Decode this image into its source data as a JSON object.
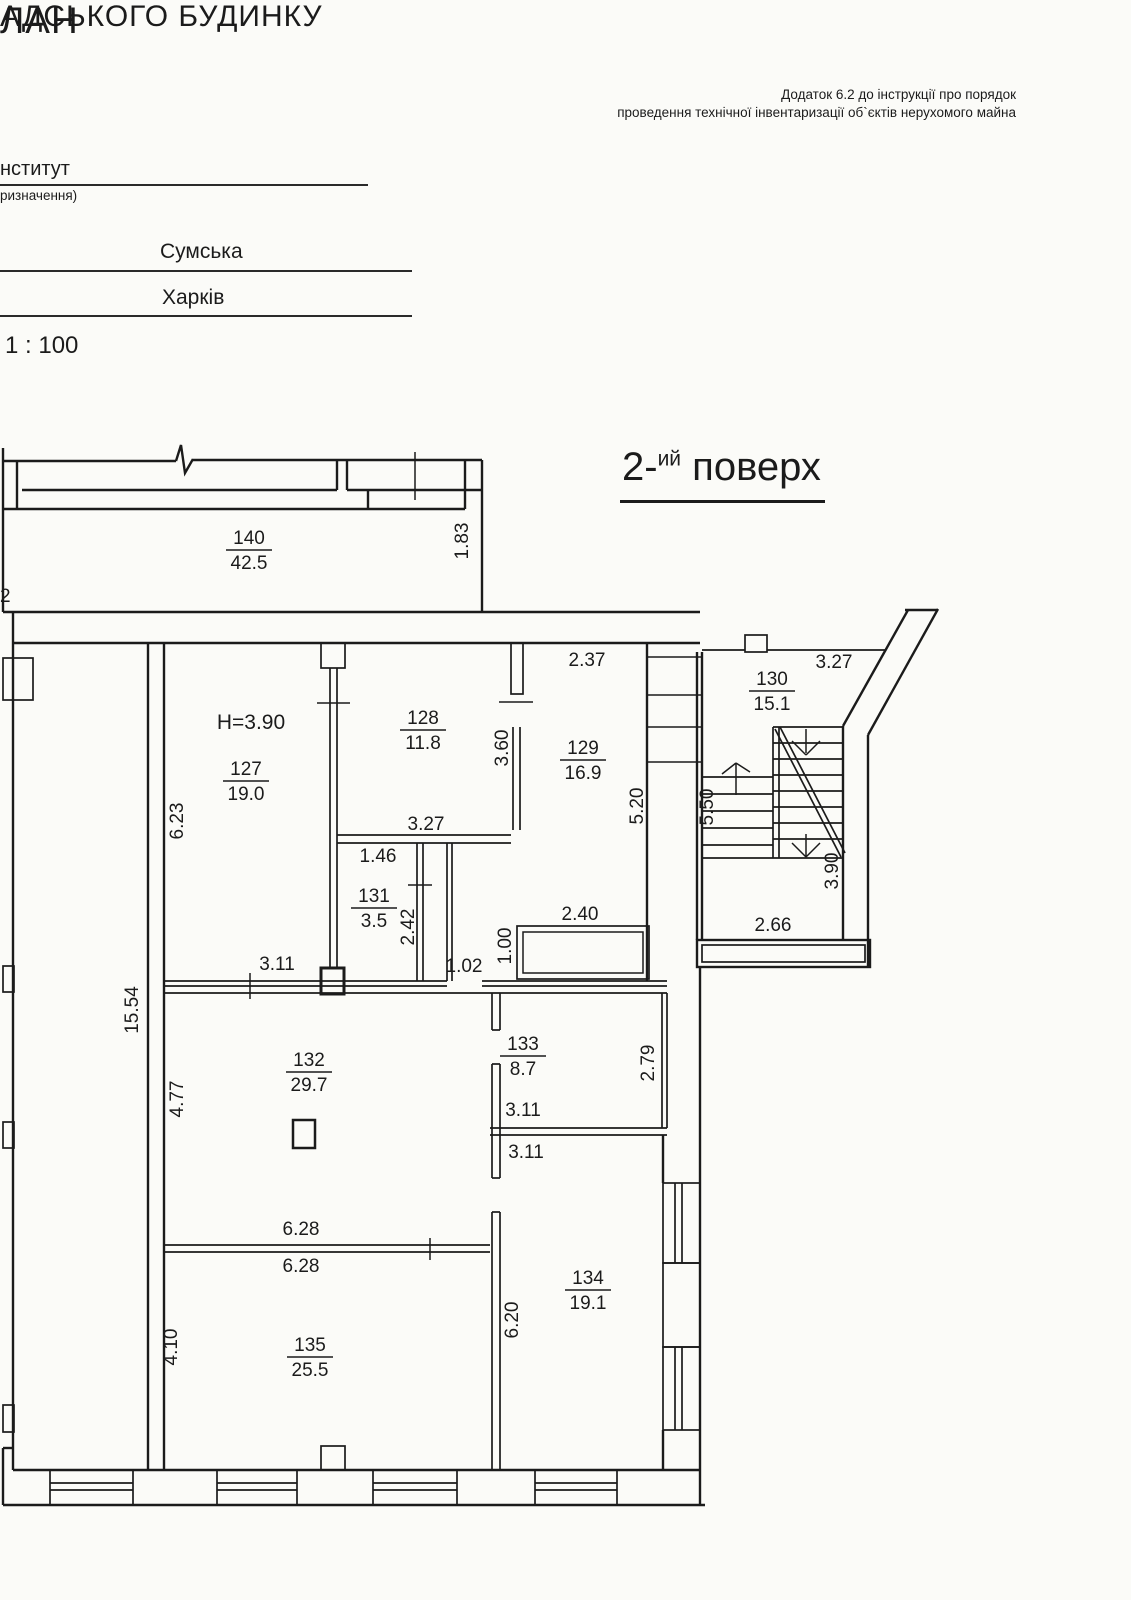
{
  "document": {
    "title_fragment_line1": "ЛАН",
    "title_fragment_line2": "АДСЬКОГО БУДИНКУ",
    "annex_note_line1": "Додаток 6.2 до інструкції про порядок",
    "annex_note_line2": "проведення технічної інвентаризації об`єктів нерухомого майна",
    "institution_fragment": "нститут",
    "institution_caption_fragment": "ризначення)",
    "street": "Сумська",
    "city": "Харків",
    "scale": "1 : 100"
  },
  "plan": {
    "floor_label": {
      "number_prefix": "2-",
      "suffix": "ий",
      "word": "поверх"
    },
    "ceiling_height": "H=3.90",
    "rooms": [
      {
        "number": "140",
        "area": "42.5"
      },
      {
        "number": "127",
        "area": "19.0"
      },
      {
        "number": "128",
        "area": "11.8"
      },
      {
        "number": "129",
        "area": "16.9"
      },
      {
        "number": "130",
        "area": "15.1"
      },
      {
        "number": "131",
        "area": "3.5"
      },
      {
        "number": "132",
        "area": "29.7"
      },
      {
        "number": "133",
        "area": "8.7"
      },
      {
        "number": "134",
        "area": "19.1"
      },
      {
        "number": "135",
        "area": "25.5"
      }
    ],
    "dimensions": {
      "room140_depth": "1.83",
      "left_cut_fragment": "2",
      "room129_width": "2.37",
      "room127_height": "6.23",
      "room128_height": "3.60",
      "room128_width": "3.27",
      "room129_height": "5.20",
      "stair_diagonal_wall": "3.27",
      "stair_flight_left": "5.50",
      "stair_flight_right": "3.90",
      "stair_width": "2.66",
      "room131_width": "1.46",
      "room131_height": "2.42",
      "corridor_segment": "3.11",
      "corridor_door": "1.02",
      "shaft_height": "1.00",
      "shaft_width": "2.40",
      "left_wall_total": "15.54",
      "room132_height": "4.77",
      "room133_height": "2.79",
      "room133_width": "3.11",
      "room134_width": "3.11",
      "room132_width": "6.28",
      "room135_width": "6.28",
      "room135_height": "4.10",
      "room134_height": "6.20"
    }
  }
}
